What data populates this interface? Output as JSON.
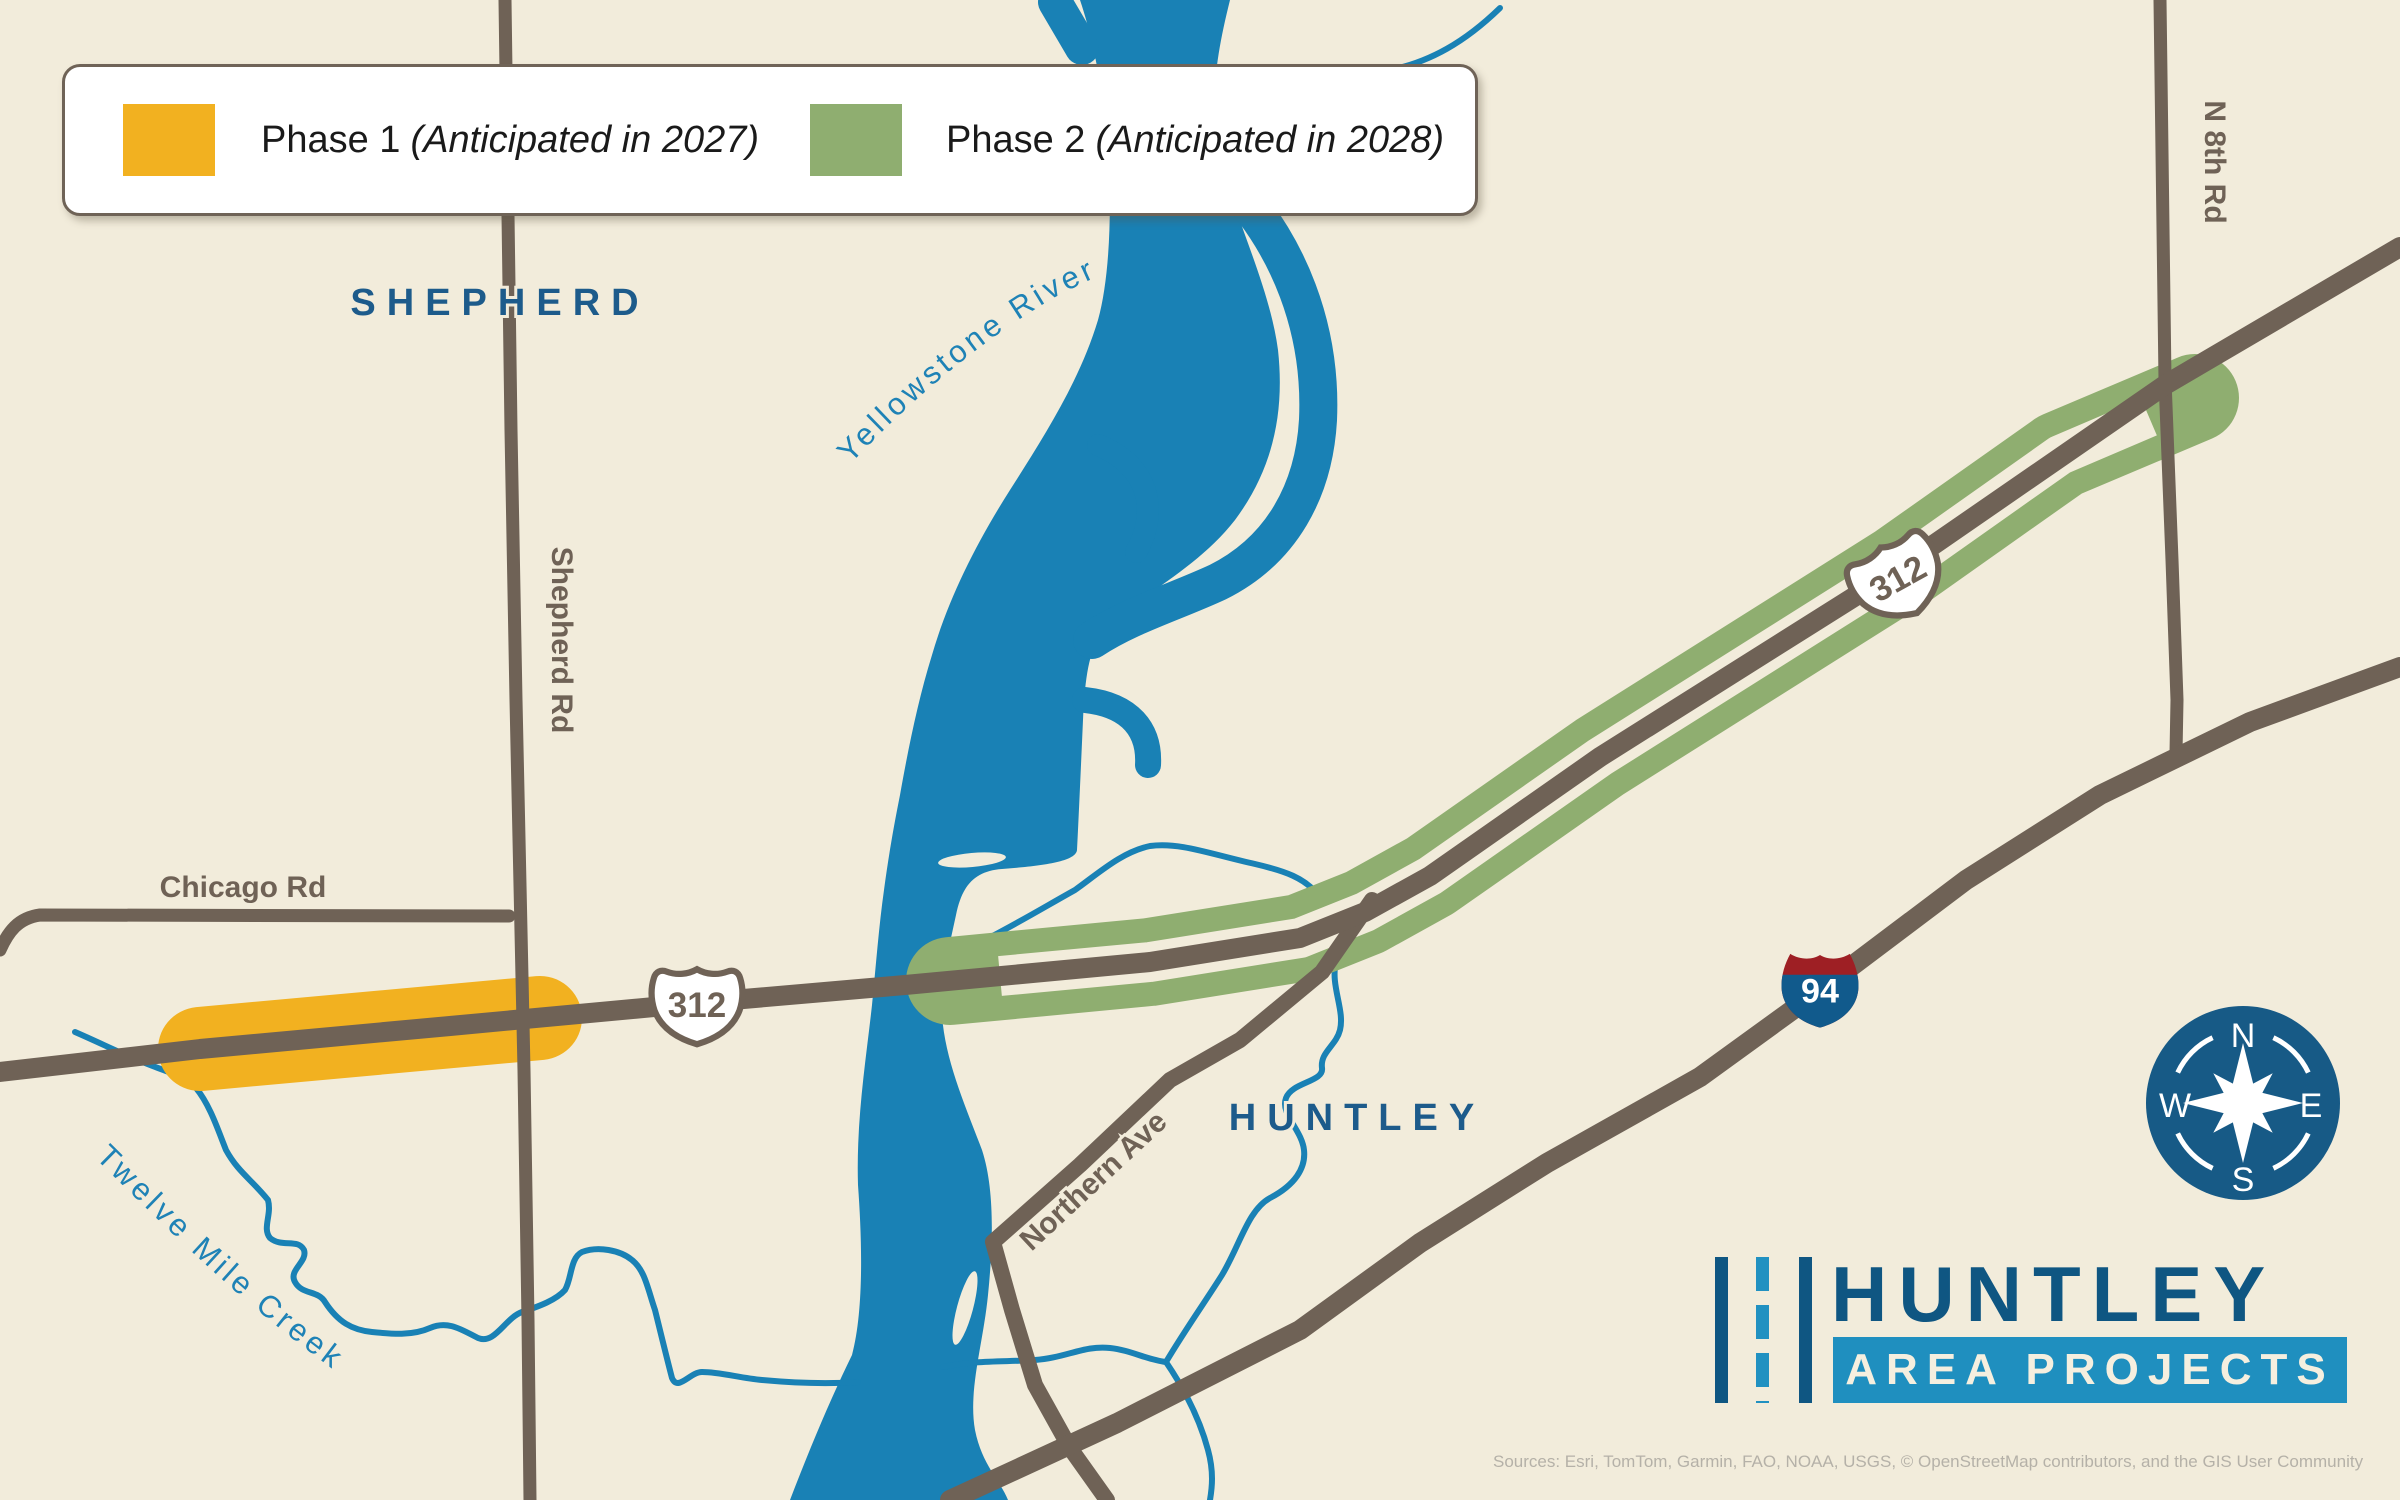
{
  "legend": {
    "items": [
      {
        "label": "Phase 1",
        "note": "(Anticipated in 2027)",
        "color": "#F2B120"
      },
      {
        "label": "Phase 2",
        "note": "(Anticipated in 2028)",
        "color": "#8FAE70"
      }
    ]
  },
  "places": {
    "shepherd": "SHEPHERD",
    "huntley": "HUNTLEY"
  },
  "road_labels": {
    "shepherd_rd": "Shepherd Rd",
    "chicago_rd": "Chicago Rd",
    "n_8th_rd": "N 8th Rd",
    "northern_ave": "Northern Ave"
  },
  "water_labels": {
    "yellowstone_river": "Yellowstone River",
    "twelve_mile_creek": "Twelve Mile Creek"
  },
  "route_shields": {
    "us_312": "312",
    "interstate_94": "94"
  },
  "compass": {
    "north": "N",
    "east": "E",
    "south": "S",
    "west": "W"
  },
  "logo": {
    "title": "HUNTLEY",
    "subtitle": "AREA PROJECTS"
  },
  "attribution": "Sources: Esri, TomTom, Garmin, FAO, NOAA, USGS, © OpenStreetMap contributors, and the GIS User Community",
  "colors": {
    "background": "#F2ECDB",
    "water": "#1981B5",
    "road": "#6F6256",
    "phase1": "#F2B120",
    "phase2": "#8FAE70",
    "place_label": "#1D5B8B",
    "water_label": "#1E82B6",
    "compass_circle": "#175A86",
    "logo_primary": "#0F5682",
    "logo_accent": "#1F8FBF",
    "shield_red": "#9E1F24",
    "shield_blue": "#115A8C"
  }
}
